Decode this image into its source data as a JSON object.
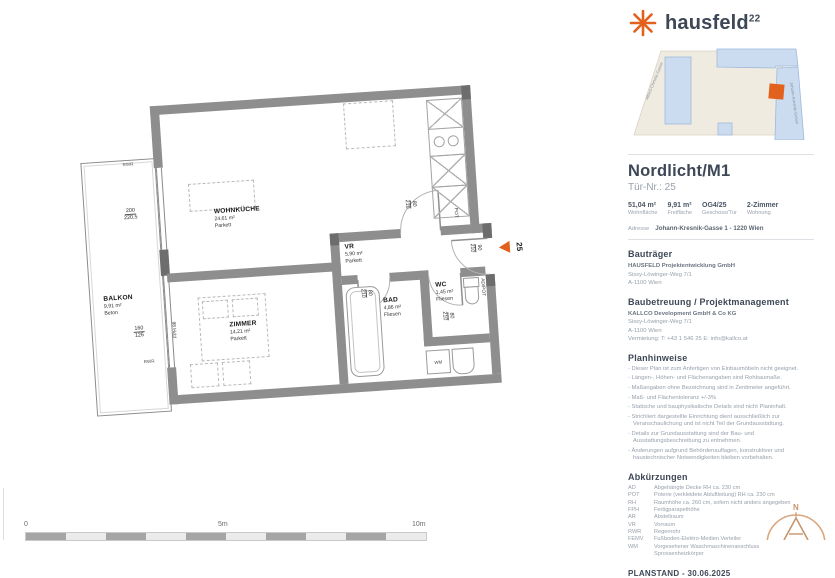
{
  "colors": {
    "accent": "#e2611c",
    "heading": "#3d4756",
    "body_text": "#97a0ab",
    "wall": "#8e8e8e",
    "wall_dark": "#6d6d6d",
    "site_bg": "#f0ebe1",
    "site_building": "#ccdcf0",
    "site_building_border": "#9fb8d8"
  },
  "logo": {
    "brand": "hausfeld",
    "sup": "22"
  },
  "site_plan": {
    "street_left": "Alfred-Chmela-Gasse",
    "street_right": "Johann-Kresnik-Gasse"
  },
  "unit": {
    "project": "Nordlicht",
    "variant": "/M1",
    "door_label": "Tür-Nr.: 25",
    "stats": [
      {
        "value": "51,04 m²",
        "label": "Wohnfläche"
      },
      {
        "value": "9,91 m²",
        "label": "Freifläche"
      },
      {
        "value": "OG4/25",
        "label": "Geschoss/Tür"
      },
      {
        "value": "2-Zimmer",
        "label": "Wohnung"
      }
    ],
    "address_label": "Adresse",
    "address": "Johann-Kresnik-Gasse 1 - 1220 Wien"
  },
  "developer": {
    "heading": "Bauträger",
    "lines": [
      "HAUSFELD Projektentwicklung GmbH",
      "Sissy-Löwinger-Weg 7/1",
      "A-1100 Wien"
    ]
  },
  "management": {
    "heading": "Baubetreuung / Projektmanagement",
    "lines": [
      "KALLCO Development GmbH & Co KG",
      "Sissy-Löwinger-Weg 7/1",
      "A-1100 Wien",
      "Vermietung: T: +43 1 546 25  E: info@kallco.at"
    ]
  },
  "plan_notes": {
    "heading": "Planhinweise",
    "items": [
      "Dieser Plan ist zum Anfertigen von Einbaumöbeln nicht geeignet.",
      "Längen-, Höhen- und Flächenangaben sind Rohbaumaße.",
      "Maßangaben ohne Bezeichnung sind in Zentimeter angeführt.",
      "Maß- und Flächentoleranz +/-3%",
      "Statische und bauphysikalische Details sind nicht Planinhalt.",
      "Strichliert dargestellte Einrichtung dient ausschließlich zur Veranschaulichung und ist nicht Teil der Grundausstattung.",
      "Details zur Grundausstattung sind der Bau- und Ausstattungsbeschreibung zu entnehmen.",
      "Änderungen aufgrund Behördenauflagen, konstruktiver und haustechnischer Notwendigkeiten bleiben vorbehalten."
    ]
  },
  "abbreviations": {
    "heading": "Abkürzungen",
    "items": [
      {
        "abbr": "AD",
        "text": "Abgehängte Decke RH ca. 230 cm"
      },
      {
        "abbr": "POT",
        "text": "Poterie (verkleidete Abluftleitung) RH ca. 230 cm"
      },
      {
        "abbr": "RH",
        "text": "Raumhöhe ca. 260 cm, sofern nicht anders angegeben"
      },
      {
        "abbr": "FPH",
        "text": "Fertigparapethöhe"
      },
      {
        "abbr": "AR",
        "text": "Abstellraum"
      },
      {
        "abbr": "VR",
        "text": "Vorraum"
      },
      {
        "abbr": "RWR",
        "text": "Regenrohr"
      },
      {
        "abbr": "FEMV",
        "text": "Fußboden-Elektro-Medien Verteiler"
      },
      {
        "abbr": "WM",
        "text": "Vorgesehener Waschmaschinenanschluss"
      },
      {
        "abbr": "",
        "text": "Sprossenheizkörper"
      }
    ]
  },
  "floor_plan": {
    "rooms": [
      {
        "name": "WOHNKÜCHE",
        "area": "24,61 m²",
        "floor": "Parkett"
      },
      {
        "name": "ZIMMER",
        "area": "14,21 m²",
        "floor": "Parkett"
      },
      {
        "name": "VR",
        "area": "5,90 m²",
        "floor": "Parkett"
      },
      {
        "name": "BAD",
        "area": "4,86 m²",
        "floor": "Fliesen"
      },
      {
        "name": "WC",
        "area": "1,45 m²",
        "floor": "Fliesen"
      },
      {
        "name": "BALKON",
        "area": "9,91 m²",
        "floor": "Beton"
      }
    ],
    "annotations": {
      "window1_w": "200",
      "window1_h": "220,5",
      "window2_w": "160",
      "window2_h": "126",
      "door_interior_w": "80",
      "door_interior_h": "210",
      "door_entry_w": "90",
      "door_entry_h": "210",
      "fph": "FPH 88",
      "rwr": "RWR",
      "pot": "POT",
      "ad_pot": "AD/POT",
      "wm": "WM",
      "entry_number": "25"
    }
  },
  "scale_bar": {
    "start": "0",
    "mid": "5m",
    "end": "10m"
  },
  "footer": {
    "planstand": "PLANSTAND - 30.06.2025",
    "compass_north": "N"
  }
}
